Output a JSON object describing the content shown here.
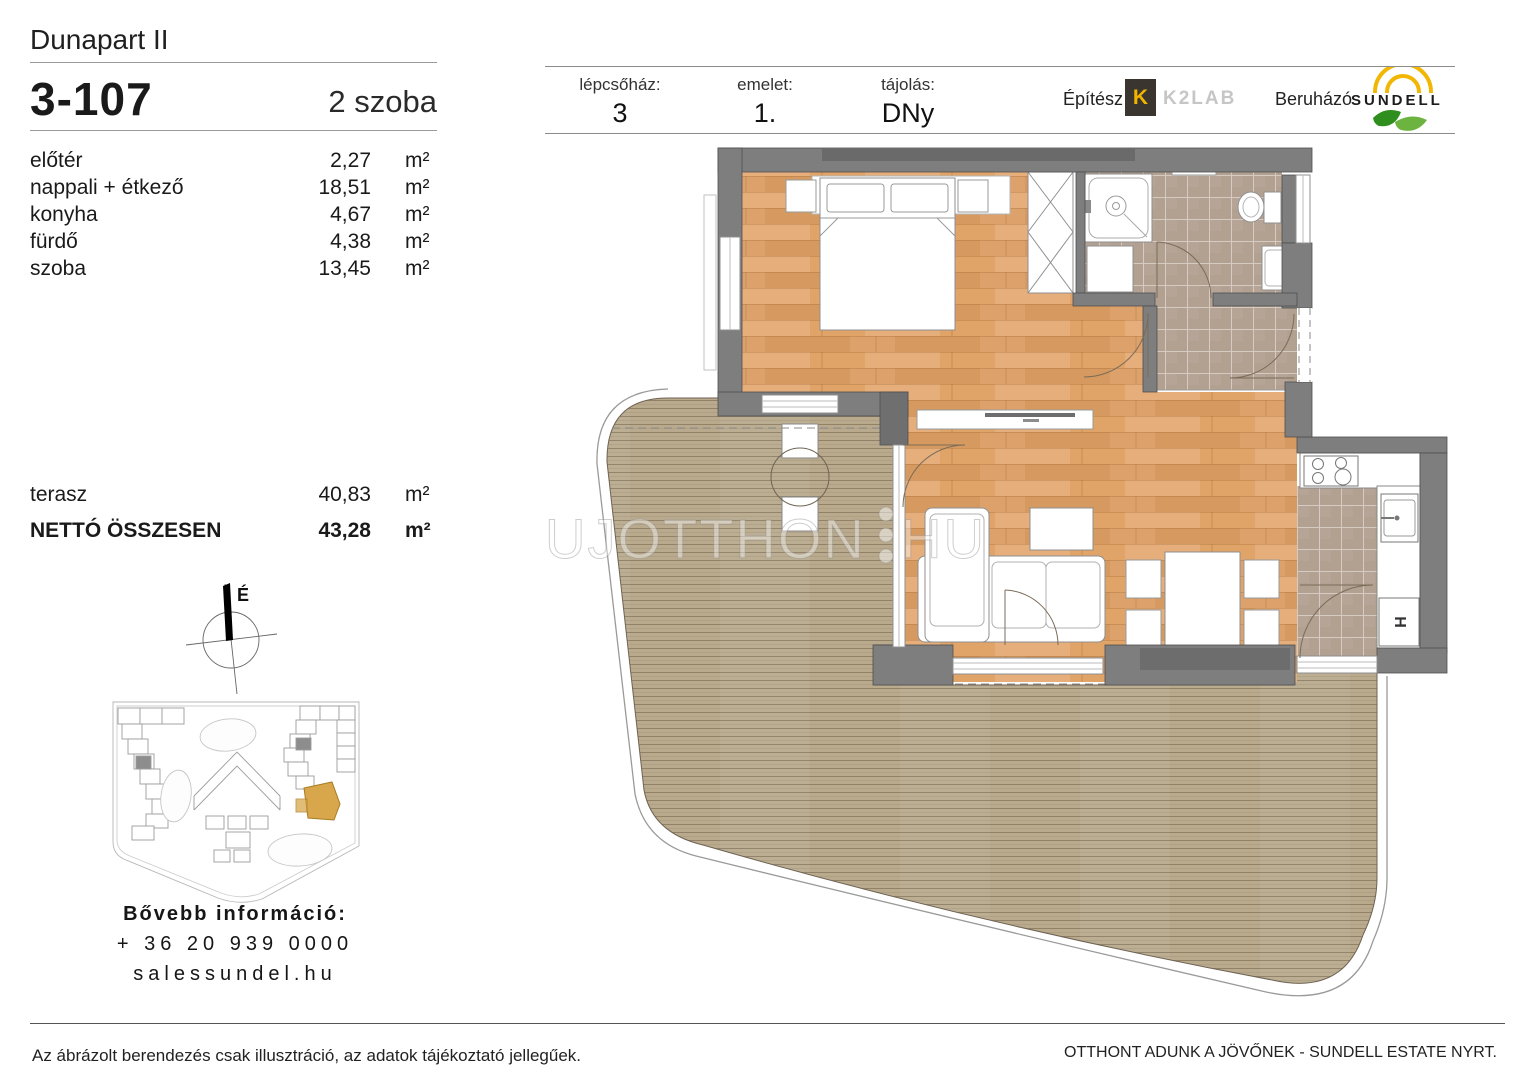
{
  "page": {
    "title": "Dunapart II",
    "unit_id": "3-107",
    "unit_type": "2 szoba"
  },
  "area_table": {
    "rows": [
      {
        "label": "előtér",
        "value": "2,27",
        "unit": "m²"
      },
      {
        "label": "nappali + étkező",
        "value": "18,51",
        "unit": "m²"
      },
      {
        "label": "konyha",
        "value": "4,67",
        "unit": "m²"
      },
      {
        "label": "fürdő",
        "value": "4,38",
        "unit": "m²"
      },
      {
        "label": "szoba",
        "value": "13,45",
        "unit": "m²"
      }
    ],
    "terrace": {
      "label": "terasz",
      "value": "40,83",
      "unit": "m²"
    },
    "total": {
      "label": "NETTÓ ÖSSZESEN",
      "value": "43,28",
      "unit": "m²"
    }
  },
  "header_fields": [
    {
      "label": "lépcsőház:",
      "value": "3"
    },
    {
      "label": "emelet:",
      "value": "1."
    },
    {
      "label": "tájolás:",
      "value": "DNy"
    }
  ],
  "branding": {
    "architect_label": "Építész",
    "architect_mark": "K",
    "architect_logo_text": "K2LAB",
    "developer_label": "Beruházó",
    "developer_logo_text": "SUNDELL"
  },
  "compass": {
    "north": "É"
  },
  "contact": {
    "heading": "Bővebb információ:",
    "phone": "+ 36 20 939 0000",
    "website": "salessundel.hu"
  },
  "watermark": {
    "left": "UJOTTHON",
    "right": "HU"
  },
  "plan": {
    "fridge_label": "H"
  },
  "footer": {
    "disclaimer": "Az ábrázolt berendezés csak illusztráció, az adatok tájékoztató jellegűek.",
    "slogan": "OTTHONT ADUNK A JÖVŐNEK - SUNDELL ESTATE NYRT."
  },
  "colors": {
    "room_wood": "#dfa671",
    "deck_wood": "#b9aa8d",
    "tile": "#b2a091",
    "wall_gray": "#7e7e7e",
    "highlight_orange": "#d9a74b",
    "brand_yellow": "#f0b400",
    "brand_green": "#4a9e2f"
  }
}
